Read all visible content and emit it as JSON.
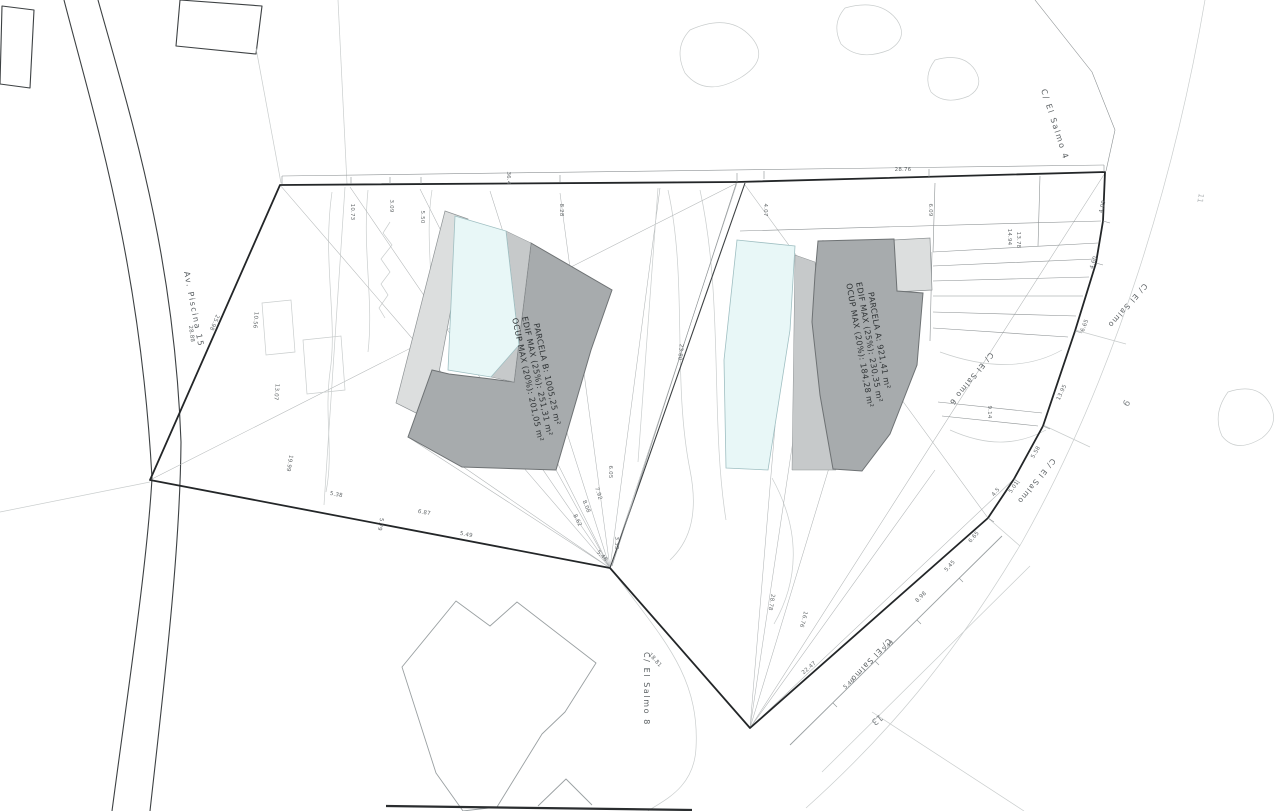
{
  "colors": {
    "pool": "#e8f7f7",
    "building": "#a7abad",
    "terrace": "#dcdede",
    "band": "#c6c9ca"
  },
  "parcels": {
    "b": {
      "lines": [
        "PARCELA B: 1005,25 m²",
        "EDIF MAX (25%): 251,31 m²",
        "OCUP MAX (20%): 201,05 m²"
      ]
    },
    "a": {
      "lines": [
        "PARCELA A: 921,41 m²",
        "EDIF MAX (25%): 230,35 m²",
        "OCUP MAX (20%): 184,28 m²"
      ]
    }
  },
  "street_labels": [
    "C/ El Salmo 4",
    "Av. Piscina 15",
    "C/ El Salmo 8",
    "C/ El Salmo 6",
    "C/ El Salmo",
    "C/ El Salmo",
    "C/ El Salmo"
  ],
  "lot_numbers": [
    "9",
    "11",
    "13"
  ],
  "dimensions": [
    "36.4",
    "28.76",
    "10.73",
    "3.09",
    "5.50",
    "8.28",
    "4.07",
    "6.09",
    "23.80",
    "25.98",
    "28.88",
    "10.56",
    "13.07",
    "19.99",
    "5.38",
    "5.79",
    "6.87",
    "5.49",
    "6.05",
    "7.92",
    "8.08",
    "8.62",
    "3.33",
    "5.48",
    "28.78",
    "16.76",
    "22.47",
    "5.46",
    "5.49",
    "8.98",
    "5.45",
    "6.65",
    "4.5",
    "5.01",
    "5.58",
    "13.95",
    "9.14",
    "6.65",
    "4.60",
    "4.09",
    "14.94",
    "13.78",
    "18.81"
  ]
}
